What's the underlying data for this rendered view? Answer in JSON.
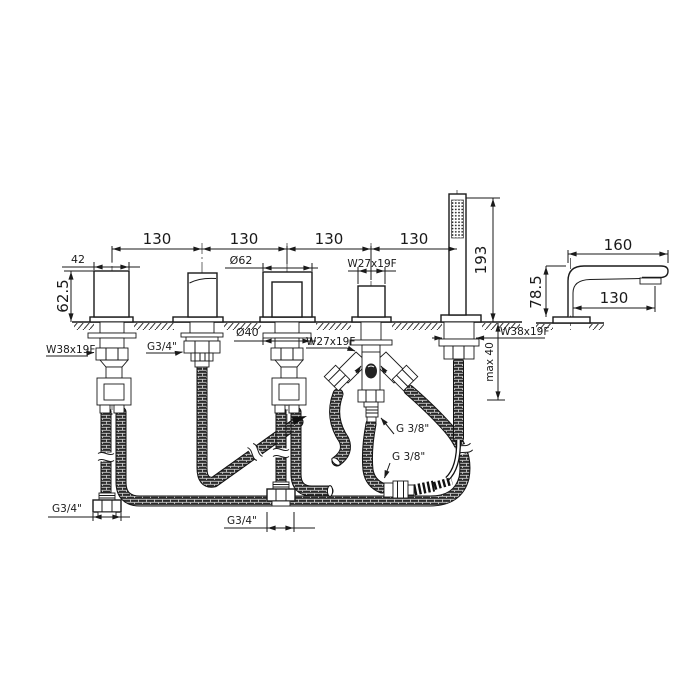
{
  "drawing": {
    "title": "bath-mixer-installation-drawing",
    "front": {
      "top_spacing": [
        "130",
        "130",
        "130",
        "130"
      ],
      "handle_width": "42",
      "handle_height": "62.5",
      "sleeve_diameter": "Ø62",
      "diverter_thread_top": "W27x19F",
      "handshower_height": "193",
      "valve_thread": "W38x19F",
      "spout_thread": "G3/4\"",
      "nut_diameter": "Ø40",
      "diverter_thread_bottom": "W27x19F",
      "handshower_mount_thread": "W38x19F",
      "max_deck_thickness": "max 40",
      "diverter_outlet_thread": "G 3/8\"",
      "hose_coupling_thread": "G 3/8\"",
      "supply_left_thread": "G3/4\"",
      "supply_center_thread": "G3/4\""
    },
    "side": {
      "spout_length": "160",
      "spout_reach": "130",
      "spout_height": "78.5"
    }
  }
}
